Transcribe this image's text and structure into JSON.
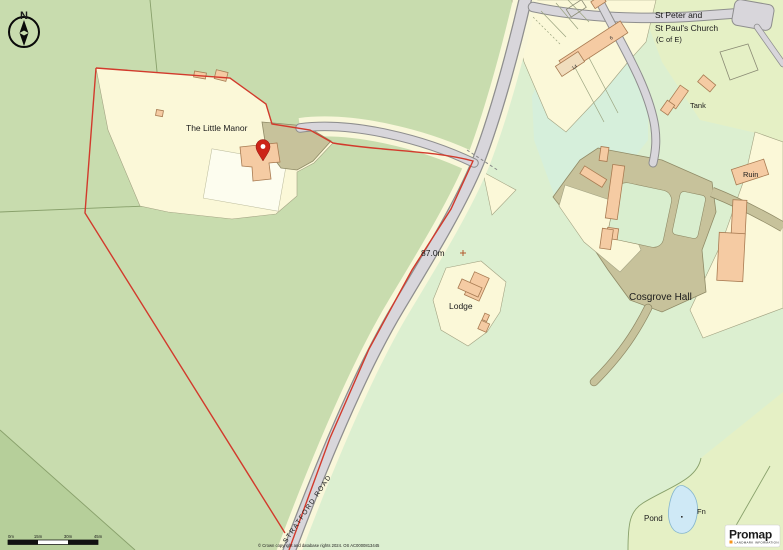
{
  "labels": {
    "church_line1": "St Peter and",
    "church_line2": "St Paul's Church",
    "church_line3": "(C of E)",
    "tank": "Tank",
    "ruin": "Ruin",
    "cosgrove_hall": "Cosgrove Hall",
    "little_manor": "The Little Manor",
    "lodge": "Lodge",
    "spot_height": "87.0m",
    "stratford_road": "STRATFORD ROAD",
    "pond": "Pond",
    "fn": "Fn",
    "house_number_14": "14",
    "house_number_6": "6"
  },
  "compass": {
    "north": "N"
  },
  "scalebar": {
    "labels": [
      "0m",
      "15m",
      "30m",
      "45m"
    ]
  },
  "attribution": {
    "copyright": "© Crown copyright and database rights 2024. OS AC0000813445"
  },
  "logo": {
    "name": "Promap",
    "subtitle": "LANDMARK INFORMATION"
  },
  "palette": {
    "field_green": "#c8dcae",
    "estate_pale_green": "#dcefd0",
    "tint_yellow_green": "#e5f0c5",
    "cyan_field": "#d6efdb",
    "plot_cream": "#fbf8d8",
    "building_peach": "#f5cba3",
    "track_khaki": "#c7c29b",
    "road_grey": "#d8d6db",
    "boundary_red": "#d23a2c",
    "pond_blue": "#cfe9f6",
    "pond_label_blue": "#2a9fd8",
    "logo_accent_orange": "#f7941d"
  }
}
